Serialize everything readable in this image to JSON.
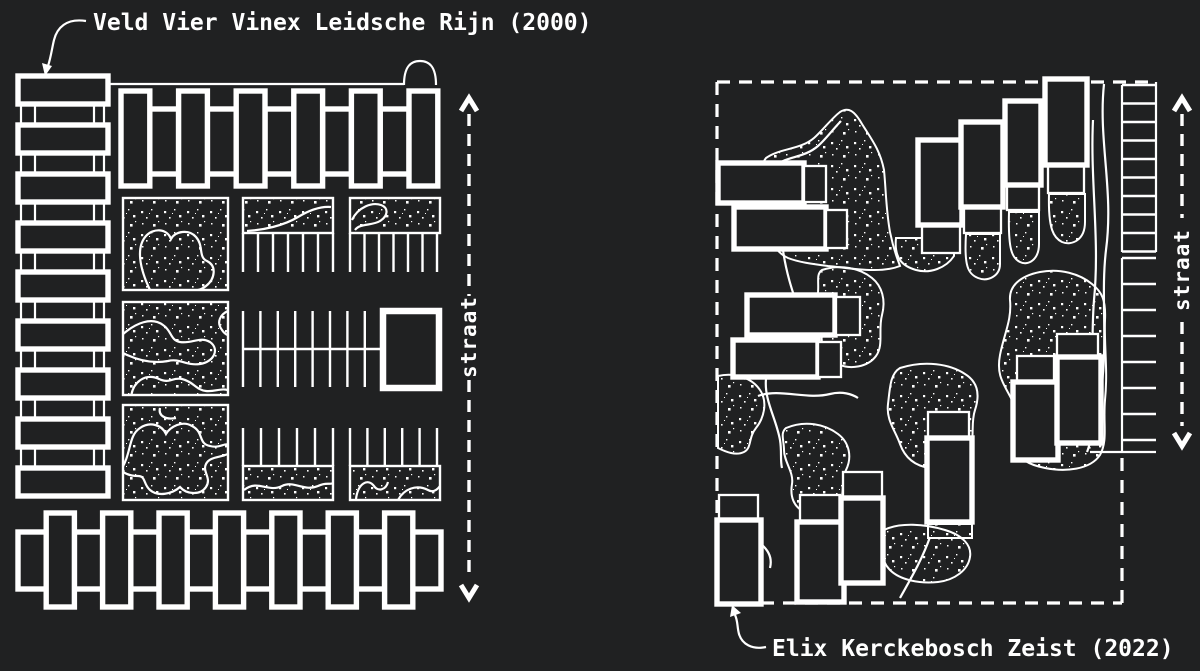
{
  "canvas": {
    "background_color": "#202122",
    "line_color": "#ffffff"
  },
  "left_plan": {
    "title": "Veld Vier Vinex Leidsche Rijn (2000)",
    "street_label": "straat"
  },
  "right_plan": {
    "title": "Elix Kerckebosch Zeist (2022)",
    "street_label": "straat"
  }
}
